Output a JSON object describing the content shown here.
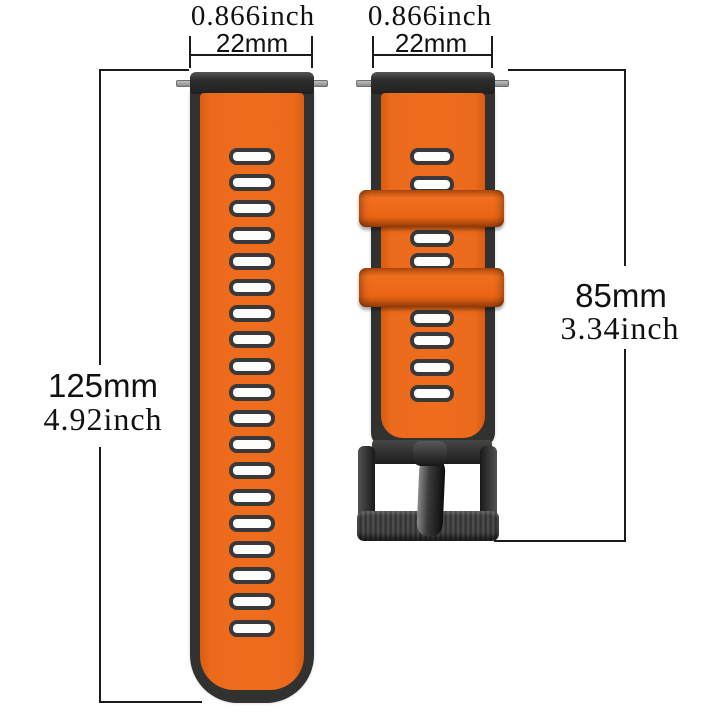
{
  "diagram": {
    "title": "watch-band-dimension-diagram",
    "background": "#ffffff",
    "line_color": "#1b1b1b",
    "colors": {
      "band_orange": "#ec6a1b",
      "band_dark": "#31312f",
      "hole_fill": "#fdfdfb",
      "pin_gray": "#9b9b9b",
      "buckle_black": "#2a2a2a"
    }
  },
  "long_band": {
    "width_inch": "0.866inch",
    "width_mm": "22mm",
    "length_mm": "125mm",
    "length_inch": "4.92inch",
    "holes": {
      "count": 19,
      "first_top": 148,
      "spacing": 26.2
    }
  },
  "short_band": {
    "width_inch": "0.866inch",
    "width_mm": "22mm",
    "length_mm": "85mm",
    "length_inch": "3.34inch",
    "hole_tops": [
      148,
      176,
      230,
      253,
      310,
      332,
      359,
      385
    ],
    "keepers": [
      {
        "top": 190,
        "height": 37
      },
      {
        "top": 268,
        "height": 39
      }
    ]
  }
}
